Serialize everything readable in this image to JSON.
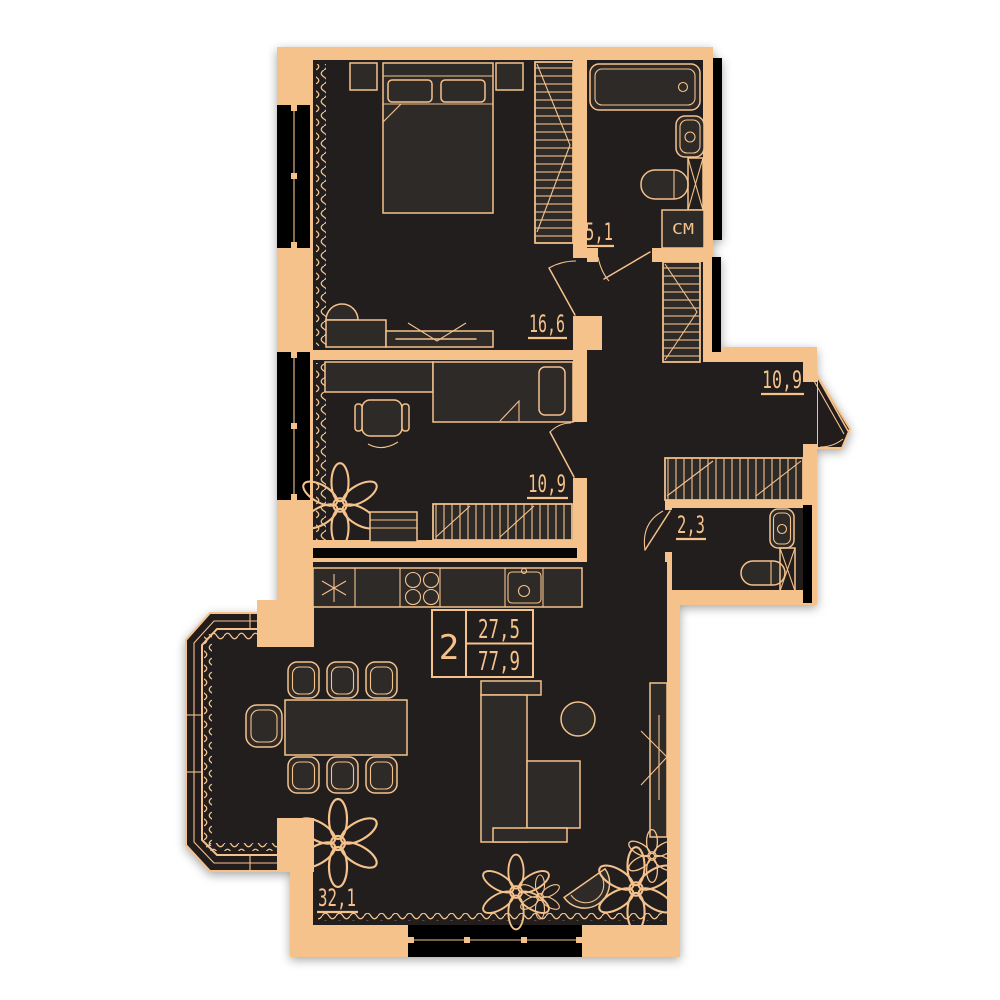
{
  "summary": {
    "room_count": "2",
    "living_area": "27,5",
    "total_area": "77,9"
  },
  "rooms": {
    "bedroom": {
      "area": "16,6"
    },
    "bathroom": {
      "area": "5,1"
    },
    "hallway": {
      "area": "10,9"
    },
    "kids_room": {
      "area": "10,9"
    },
    "wc": {
      "area": "2,3"
    },
    "living_kitchen": {
      "area": "32,1"
    }
  },
  "labels": {
    "washing_machine": "СМ"
  },
  "colors": {
    "wall": "#F5C28C",
    "room": "#211E1D",
    "furn": "#2E2A28",
    "window": "#060606",
    "bg": "#FFFFFF"
  }
}
